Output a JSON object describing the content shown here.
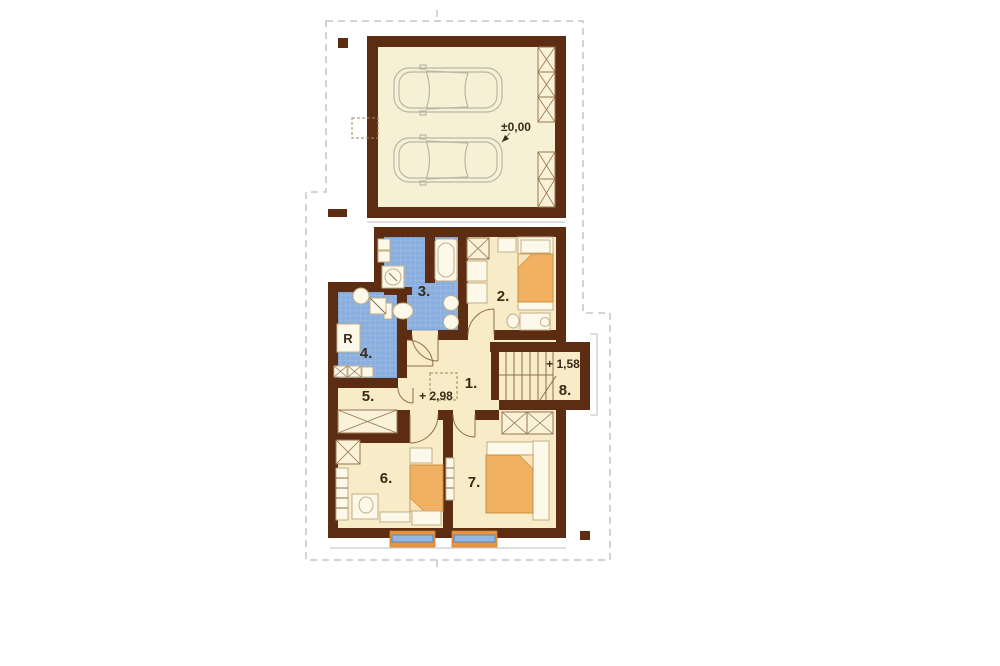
{
  "labels": {
    "garage_level": "±0,00",
    "upper_level": "+ 2,98",
    "landing_level": "+ 1,58",
    "appliance": "R"
  },
  "rooms": [
    "1.",
    "2.",
    "3.",
    "4.",
    "5.",
    "6.",
    "7.",
    "8."
  ],
  "colors": {
    "wall": "#5c2d12",
    "room_fill": "#f8ecc8",
    "garage_fill": "#f6f1d5",
    "tile_blue": "#8aaedd",
    "tile_grid": "#a8c4ea",
    "bed_orange": "#f0b163",
    "window_glass": "#93b7e0",
    "window_sill": "#e9953e",
    "roof_outline": "#c6c6c6",
    "text": "#3a2a18"
  }
}
